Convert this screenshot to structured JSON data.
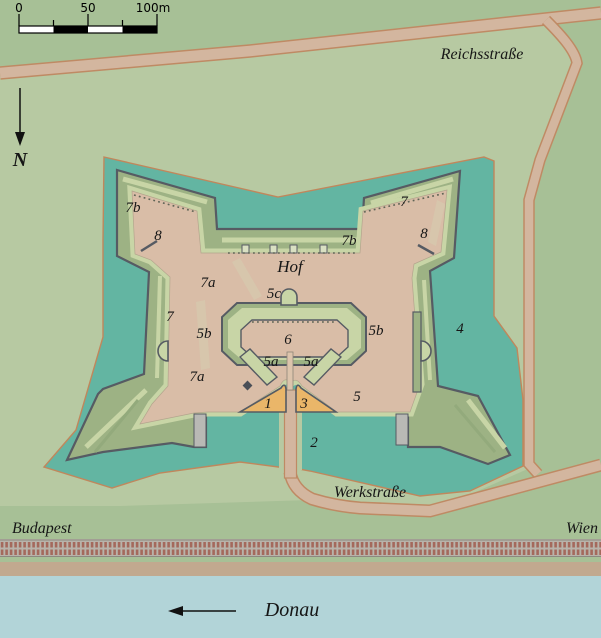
{
  "map_title": "Fort plan with surroundings",
  "scale_bar": {
    "tick_0": "0",
    "tick_50": "50",
    "tick_100": "100m"
  },
  "compass": {
    "north_label": "N"
  },
  "streets": {
    "reichsstrasse": "Reichsstraße",
    "werkstrasse": "Werkstraße"
  },
  "places": {
    "budapest": "Budapest",
    "wien": "Wien",
    "donau": "Donau"
  },
  "fort_labels": {
    "hof": "Hof",
    "n1": "1",
    "n2": "2",
    "n3": "3",
    "n4": "4",
    "n5": "5",
    "n5a_left": "5a",
    "n5a_right": "5a",
    "n5b_left": "5b",
    "n5b_right": "5b",
    "n5c": "5c",
    "n6": "6",
    "n7_left": "7",
    "n7_right": "7",
    "n7a_upper": "7a",
    "n7a_lower": "7a",
    "n7b_left": "7b",
    "n7b_center": "7b",
    "n8_left": "8",
    "n8_right": "8"
  },
  "colors": {
    "terrain": "#a7c096",
    "glacis": "#b7c9a2",
    "moat": "#63b5a2",
    "moat_outline": "#c0875c",
    "rampart": "#9db284",
    "crest": "#c8d5a6",
    "interior": "#d9bda7",
    "outline": "#565b63",
    "road": "#d3b69f",
    "road_outline": "#bf8a64",
    "gate_orange": "#eab669",
    "water": "#b2d4d8",
    "rail_bed": "#b8b3aa",
    "rail_tie": "#a4695c",
    "embankment": "#c1a98f"
  }
}
